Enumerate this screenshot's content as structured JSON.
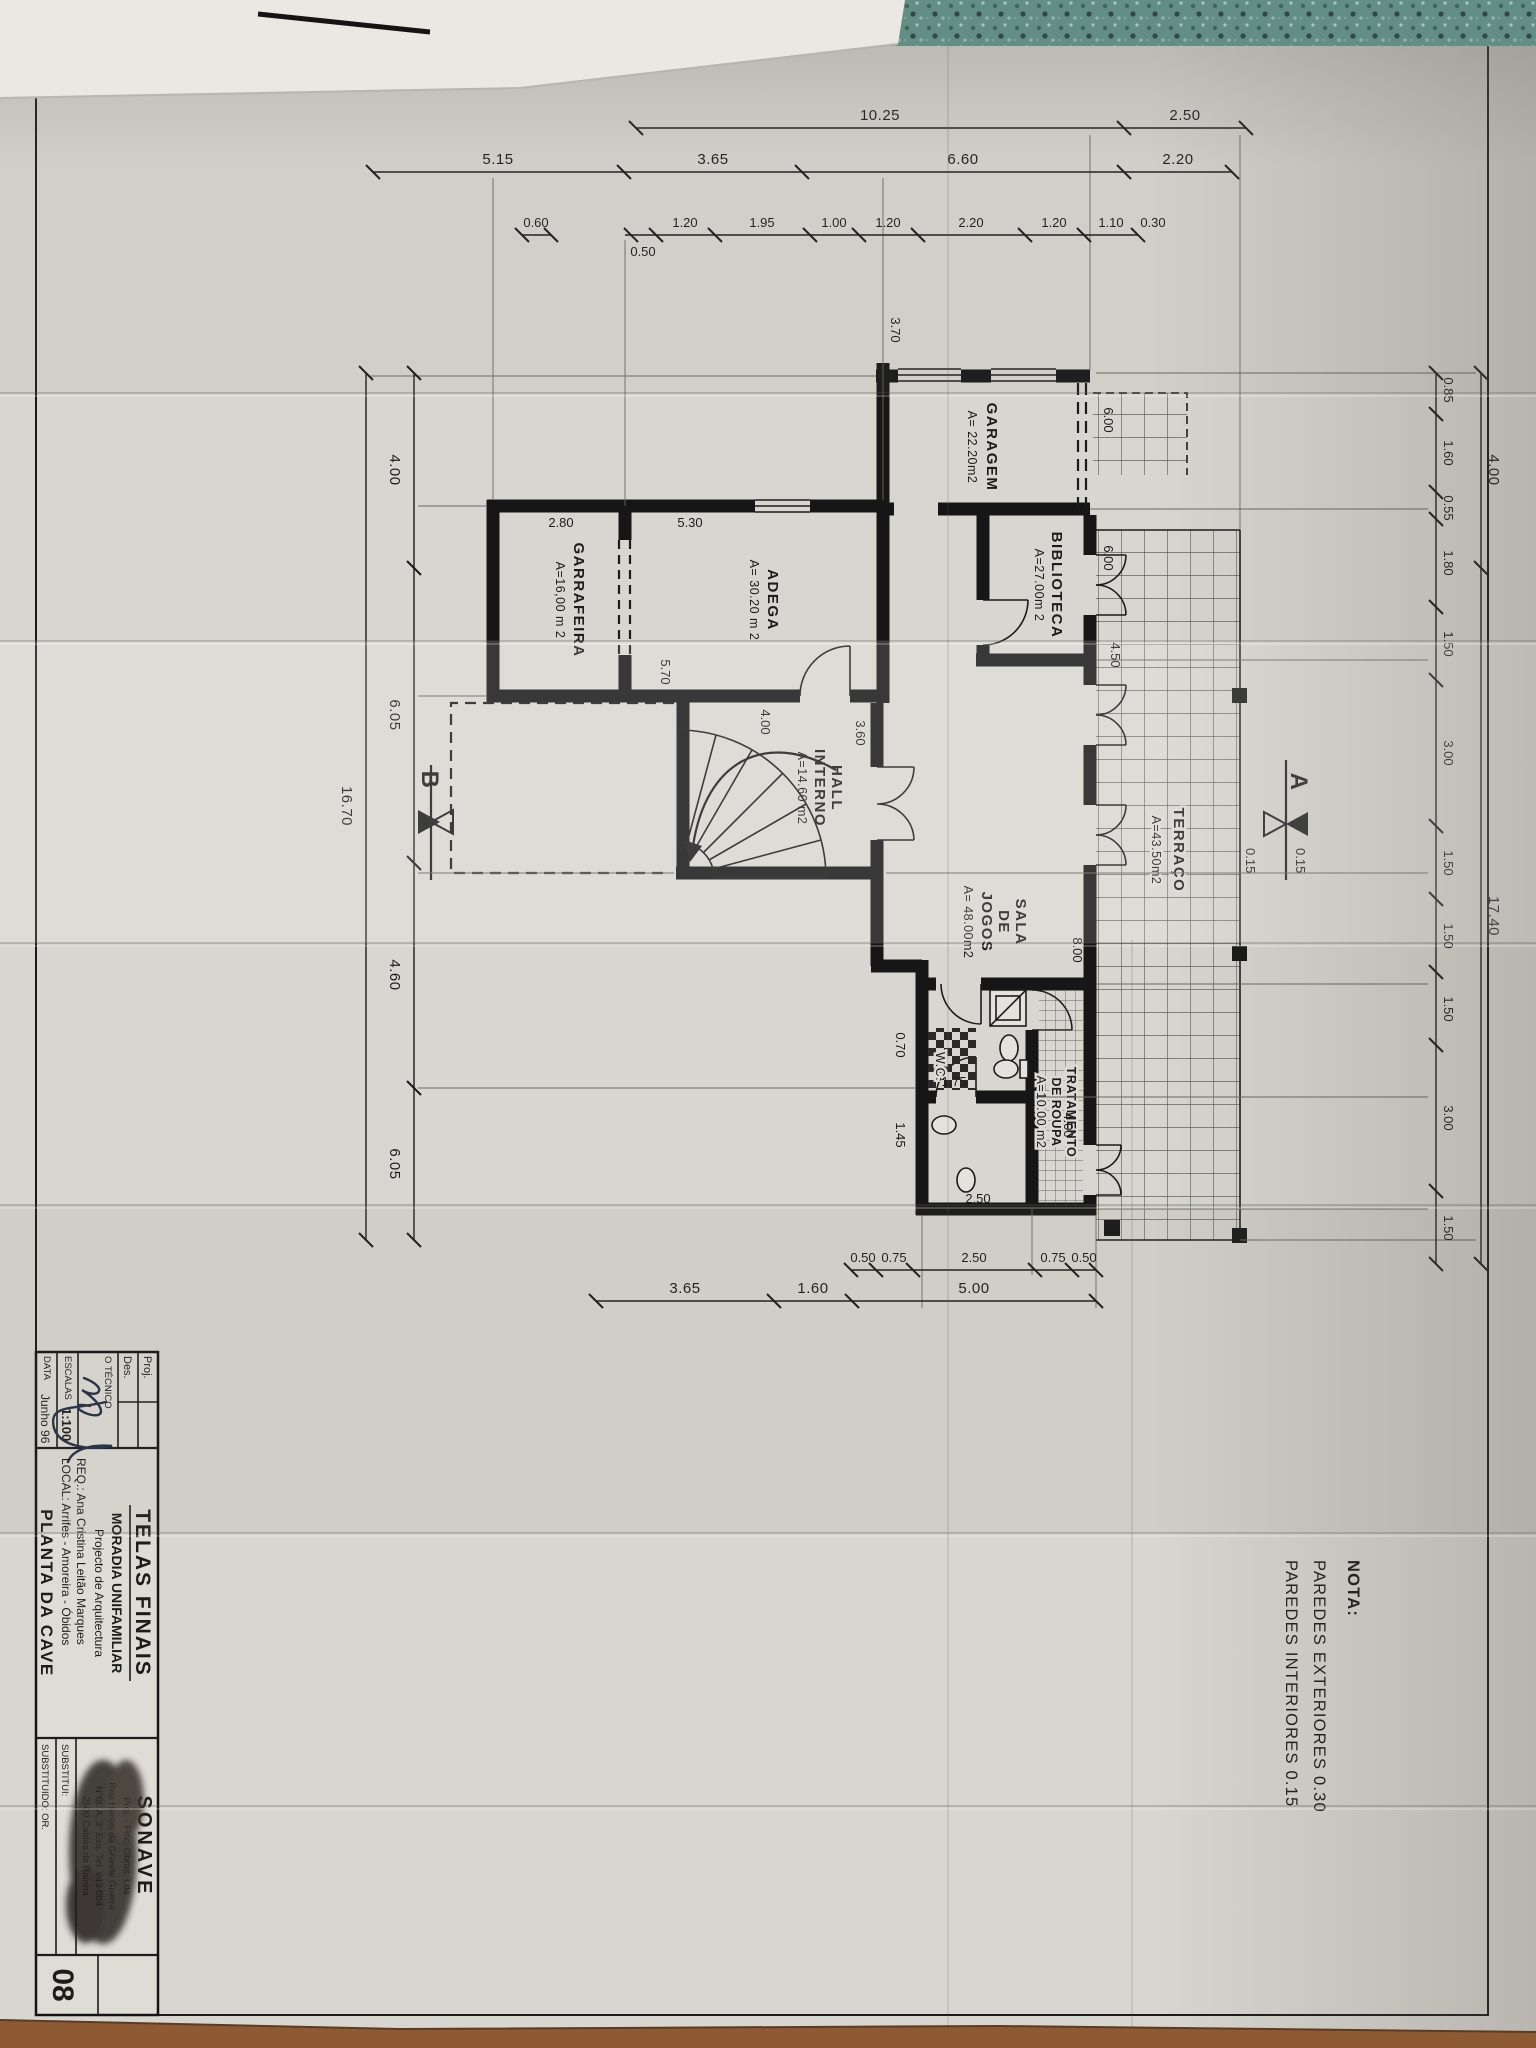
{
  "surface": {
    "top_color": "#5f8b82",
    "bottom_color": "#8e5a33",
    "paper_color": "#d8d6d0",
    "ink_color": "#1c1c1c"
  },
  "note": {
    "title": "NOTA:",
    "line1": "PAREDES EXTERIORES  0.30",
    "line2": "PAREDES INTERIORES  0.15"
  },
  "rooms": {
    "garagem": {
      "name": "GARAGEM",
      "area": "A= 22.20m2"
    },
    "biblioteca": {
      "name": "BIBLIOTECA",
      "area": "A=27.00m 2"
    },
    "adega": {
      "name": "ADEGA",
      "area": "A= 30.20 m 2"
    },
    "garrafeira": {
      "name": "GARRAFEIRA",
      "area": "A=16,00 m 2"
    },
    "hall": {
      "name1": "HALL",
      "name2": "INTERNO",
      "area": "A=14.60 m2"
    },
    "sala": {
      "name1": "SALA",
      "name2": "DE",
      "name3": "JOGOS",
      "area": "A= 48.00m2"
    },
    "tratamento": {
      "name1": "TRATAMENTO",
      "name2": "DE ROUPA",
      "area": "A=10.00 m2"
    },
    "terraco": {
      "name": "TERRAÇO",
      "area": "A=43.50m2"
    },
    "wc": {
      "name": "W.C."
    }
  },
  "dims": {
    "top_outer": [
      "4.00",
      "17.40"
    ],
    "top_inner": [
      "0.85",
      "1.60",
      "0.55",
      "1.80",
      "1.50",
      "3.00",
      "1.50",
      "1.50",
      "1.50",
      "3.00",
      "1.50"
    ],
    "left_outer": [
      "2.50",
      "10.25"
    ],
    "left_mid": [
      "2.20",
      "6.60",
      "3.65",
      "5.15"
    ],
    "left_inner": [
      "0.30",
      "1.10",
      "1.20",
      "2.20",
      "1.20",
      "1.00",
      "1.95",
      "1.20",
      "0.50",
      "0.60"
    ],
    "right_inner": [
      "0.50",
      "0.75",
      "2.50",
      "0.75",
      "0.50"
    ],
    "right_outer": [
      "5.00",
      "1.60",
      "3.65"
    ],
    "bottom_inner": [
      "4.00",
      "6.05",
      "4.60",
      "6.05"
    ],
    "bottom_outer": [
      "16.70"
    ],
    "interior": {
      "garage_w": "3.70",
      "adega_w": "5.30",
      "garraf_w": "2.80",
      "divider": "5.70",
      "hall_w": "3.60",
      "hall_h": "4.00",
      "n1": "6.00",
      "n2": "6.00",
      "n3": "4.50",
      "n4": "8.00",
      "b1": "1.45",
      "b2": "1.75",
      "b3": "0.70",
      "b4": "2.50",
      "b5": "4.00",
      "sec1": "0.15",
      "sec2": "0.15"
    }
  },
  "sections": {
    "a": "A",
    "b": "B"
  },
  "titleblock": {
    "proj": "Proj.",
    "des": "Des.",
    "tecnico": "O TÉCNICO",
    "escalas_label": "ESCALAS",
    "escalas_value": "1:100",
    "data_label": "DATA",
    "data_value": "Junho 96",
    "telas": "TELAS FINAIS",
    "moradia": "MORADIA UNIFAMILIAR",
    "projecto": "Projecto de Arquitectura",
    "req": "REQ.: Ana Cristina Leitão Marques",
    "local": "LOCAL: Arrifes - Amoreira - Óbidos",
    "planta": "PLANTA DA CAVE",
    "firm": "SONAVE",
    "firm_sub": "Proj. - Fisc. Obras, Lda",
    "firm_addr1": "Rua Heróis da Grande Guerra",
    "firm_addr2": "N°60 A, 3° Esq.  Tel. 943 004",
    "firm_addr3": "2500 Caldas da Rainha",
    "substitui": "SUBSTITUI:",
    "substituido": "SUBSTITUIDO:  OR.",
    "sheet_number": "08"
  }
}
